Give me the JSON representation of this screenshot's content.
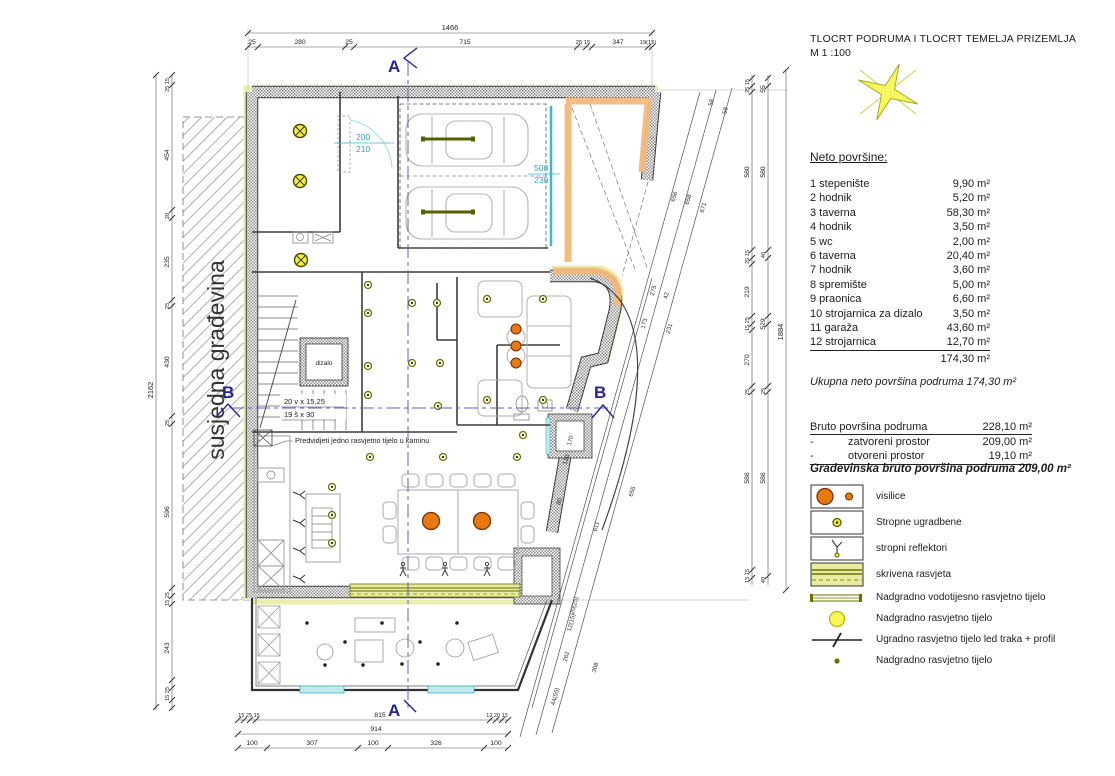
{
  "header": {
    "title": "TLOCRT PODRUMA I TLOCRT TEMELJA PRIZEMLJA",
    "scale": "M 1 :100"
  },
  "areas": {
    "heading": "Neto površine:",
    "rooms": [
      {
        "label": "1  stepenište",
        "area": "9,90 m²"
      },
      {
        "label": "2  hodnik",
        "area": "5,20 m²"
      },
      {
        "label": "3  taverna",
        "area": "58,30 m²"
      },
      {
        "label": "4  hodnik",
        "area": "3,50 m²"
      },
      {
        "label": "5  wc",
        "area": "2,00 m²"
      },
      {
        "label": "6  taverna",
        "area": "20,40 m²"
      },
      {
        "label": "7  hodnik",
        "area": "3,60 m²"
      },
      {
        "label": "8  spremište",
        "area": "5,00 m²"
      },
      {
        "label": "9  praonica",
        "area": "6,60 m²"
      },
      {
        "label": "10  strojarnica za dizalo",
        "area": "3,50 m²"
      },
      {
        "label": "11  garaža",
        "area": "43,60 m²"
      },
      {
        "label": "12  strojarnica",
        "area": "12,70 m²"
      }
    ],
    "total": "174,30 m²",
    "summary": "Ukupna neto površina  podruma  174,30 m²"
  },
  "bruto": {
    "row1_label": "Bruto površina podruma",
    "row1_val": "228,10 m²",
    "row2_dash": "-",
    "row2_label": "zatvoreni prostor",
    "row2_val": "209,00 m²",
    "row3_dash": "-",
    "row3_label": "otvoreni prostor",
    "row3_val": "19,10 m²",
    "final": "Građevinska bruto površina podruma  209,00 m²"
  },
  "legend": {
    "items": [
      {
        "symbol": "pendant-lights",
        "label": "visilice"
      },
      {
        "symbol": "recessed-ceiling-light",
        "label": "Stropne ugradbene"
      },
      {
        "symbol": "ceiling-spotlight",
        "label": "stropni reflektori"
      },
      {
        "symbol": "hidden-lighting",
        "label": "skrivena rasvjeta"
      },
      {
        "symbol": "surface-watertight-luminaire",
        "label": "Nadgradno vodotijesno rasvjetno tijelo"
      },
      {
        "symbol": "surface-luminaire-large",
        "label": "Nadgradno rasvjetno tijelo"
      },
      {
        "symbol": "recessed-led-strip-profile",
        "label": "Ugradno rasvjetno tijelo led traka + profil"
      },
      {
        "symbol": "surface-luminaire-small",
        "label": "Nadgradno rasvjetno tijelo"
      }
    ]
  },
  "plan": {
    "ann": {
      "a": "A",
      "b": "B",
      "door": "200",
      "door2": "210",
      "gar": "500",
      "gar2": "230",
      "stairs1": "20 v x 15,25",
      "stairs2": "19 š x 30",
      "dizalo": "dizalo",
      "niche": "170",
      "note": "Predvidjeti jedno rasvjetno tijelo u kaminu",
      "neighbor": "susjedna građevina"
    },
    "dims": {
      "top_total": "1466",
      "top": [
        "25",
        "280",
        "25",
        "715",
        "25 15",
        "347",
        "19(15)"
      ],
      "bottom": [
        "15 25 15",
        "815",
        "12 20 13",
        "914",
        "100",
        "307",
        "100",
        "326",
        "100"
      ],
      "left_total": "2162",
      "left": [
        "25 15",
        "454",
        "20",
        "235",
        "25",
        "430",
        "25",
        "596",
        "15 25",
        "243",
        "15 25"
      ],
      "right_a": [
        "25 15",
        "580",
        "25 15",
        "219",
        "15 25",
        "270",
        "25",
        "586",
        "15 15"
      ],
      "right_b": [
        "55",
        "580",
        "40",
        "529",
        "25",
        "586",
        "40"
      ],
      "right_total": "1884",
      "diag": [
        "656",
        "658",
        "671",
        "58",
        "58",
        "275",
        "42",
        "173",
        "231",
        "611",
        "655",
        "120",
        "80",
        "20(25)",
        "12(15)",
        "262",
        "308",
        "44(55)"
      ]
    }
  },
  "colors": {
    "orange_light": "#e8790e",
    "olive": "#6b7000",
    "lime_band": "#e9efab",
    "orange_band": "#f3b97e",
    "cyan": "#3bb8c9",
    "navy_section": "#24249a",
    "wall_gray": "#8f8f8f"
  }
}
